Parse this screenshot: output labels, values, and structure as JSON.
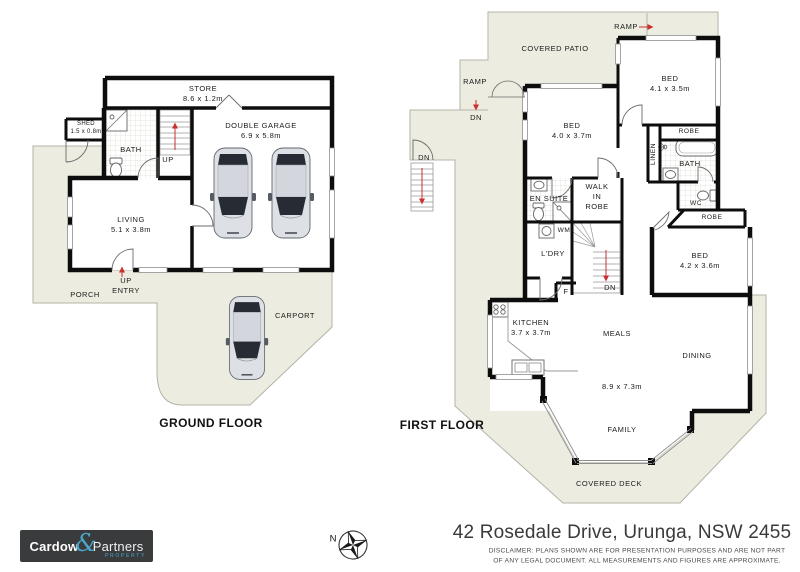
{
  "ground_floor": {
    "title": "GROUND FLOOR",
    "rooms": {
      "store": {
        "name": "STORE",
        "dims": "8.6 x 1.2m"
      },
      "shed": {
        "name": "SHED",
        "dims": "1.5 x 0.8m"
      },
      "bath": {
        "name": "BATH"
      },
      "stairs_up": {
        "name": "UP"
      },
      "garage": {
        "name": "DOUBLE GARAGE",
        "dims": "6.9 x 5.8m"
      },
      "living": {
        "name": "LIVING",
        "dims": "5.1 x 3.8m"
      },
      "entry": {
        "line1": "UP",
        "line2": "ENTRY"
      },
      "porch": {
        "name": "PORCH"
      },
      "carport": {
        "name": "CARPORT"
      }
    }
  },
  "first_floor": {
    "title": "FIRST FLOOR",
    "rooms": {
      "covered_patio": {
        "name": "COVERED PATIO"
      },
      "ramp_top": {
        "name": "RAMP"
      },
      "ramp_left": {
        "name": "RAMP"
      },
      "dn_ramp": {
        "name": "DN"
      },
      "dn_stairs": {
        "name": "DN"
      },
      "bed_top": {
        "name": "BED",
        "dims": "4.1 x 3.5m"
      },
      "bed_front": {
        "name": "BED",
        "dims": "4.0 x 3.7m"
      },
      "bed_rear": {
        "name": "BED",
        "dims": "4.2 x 3.6m"
      },
      "robe_top": {
        "name": "ROBE"
      },
      "linen": {
        "name": "LINEN"
      },
      "bath": {
        "name": "BATH"
      },
      "wc": {
        "name": "WC"
      },
      "robe_rear": {
        "name": "ROBE"
      },
      "en_suite": {
        "name": "EN SUITE"
      },
      "walk_in_robe": {
        "line1": "WALK",
        "line2": "IN",
        "line3": "ROBE"
      },
      "wm": {
        "name": "WM"
      },
      "laundry": {
        "name": "L'DRY"
      },
      "fridge": {
        "name": "F"
      },
      "dn_center": {
        "name": "DN"
      },
      "kitchen": {
        "name": "KITCHEN",
        "dims": "3.7 x 3.7m"
      },
      "meals": {
        "name": "MEALS"
      },
      "dining": {
        "name": "DINING"
      },
      "living_area": {
        "dims": "8.9 x 7.3m"
      },
      "family": {
        "name": "FAMILY"
      },
      "covered_deck": {
        "name": "COVERED DECK"
      }
    }
  },
  "footer": {
    "logo": {
      "word1": "Cardow",
      "amp": "&",
      "word2": "Partners",
      "tagline": "PROPERTY"
    },
    "compass": {
      "label": "N"
    },
    "address": "42 Rosedale Drive, Urunga, NSW 2455",
    "disclaimer_line1": "DISCLAIMER: PLANS SHOWN ARE FOR PRESENTATION PURPOSES AND ARE NOT PART",
    "disclaimer_line2": "OF ANY LEGAL DOCUMENT. ALL MEASUREMENTS AND FIGURES ARE APPROXIMATE."
  },
  "colors": {
    "floor_area": "#edece1",
    "wall": "#0d0d0d",
    "arrow_red": "#c93030",
    "logo_accent": "#4aa6c8",
    "logo_bg": "#3a3b3d"
  }
}
